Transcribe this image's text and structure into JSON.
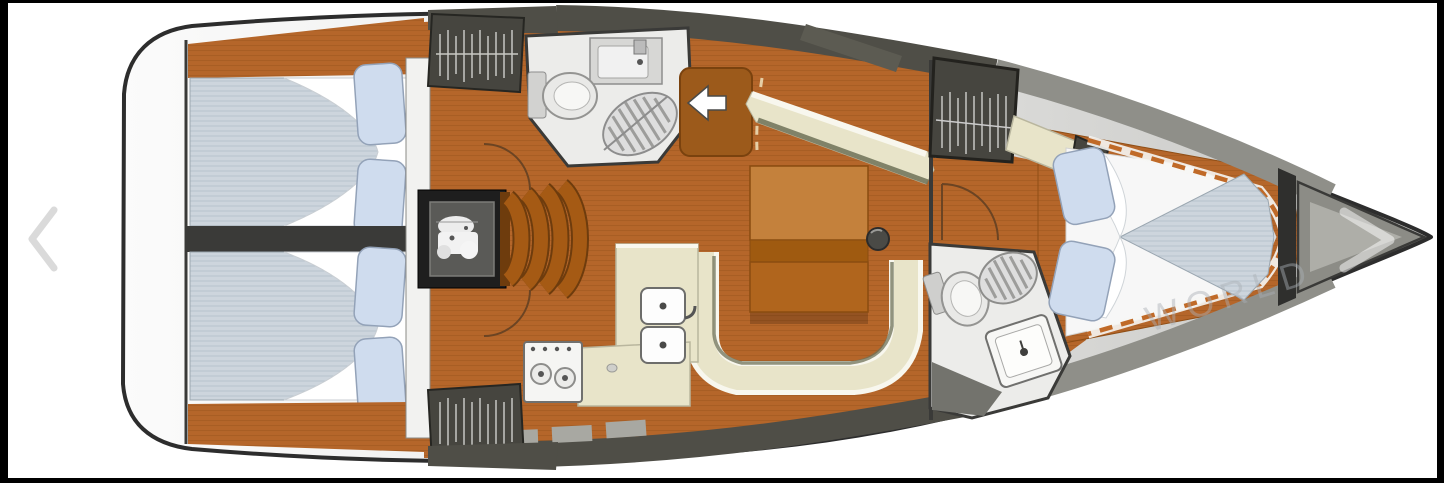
{
  "viewer": {
    "watermark": "WORLD",
    "prev_arrow_icon": "chevron-left",
    "next_arrow_icon": "chevron-right"
  },
  "plan": {
    "type": "sailboat-interior-floorplan",
    "companionway_arrow_icon": "arrow-left"
  },
  "colors": {
    "frame_black": "#000000",
    "page_white": "#ffffff",
    "hull_outline": "#2d2d2d",
    "deck_dark": "#4f4e47",
    "deck_gray": "#8f8f89",
    "floor_orange": "#b5662a",
    "plank_line": "#8f4e16",
    "table_light": "#c4813c",
    "table_mid": "#b0651d",
    "table_dark": "#9f5a10",
    "settee_cream": "#e8e4c9",
    "settee_white": "#f8f7ee",
    "settee_shadow": "#6f7258",
    "mattress_blue": "#cdd5dd",
    "mattress_line": "#b3bfc9",
    "pillow_blue": "#cfdcee",
    "linen_white": "#f7f7f7",
    "bath_floor": "#ececea",
    "wardrobe_dark": "#46453f",
    "engine_black": "#1e1e1e",
    "step_orange": "#a55a14",
    "step_edge": "#6e3c0d",
    "wall_dark": "#3a3a38",
    "dash_orange": "#c06a28",
    "watermark_gray": "#aab0b6",
    "chevron_gray": "#d6d6d6",
    "companionway_box": "#9c5a1b"
  }
}
